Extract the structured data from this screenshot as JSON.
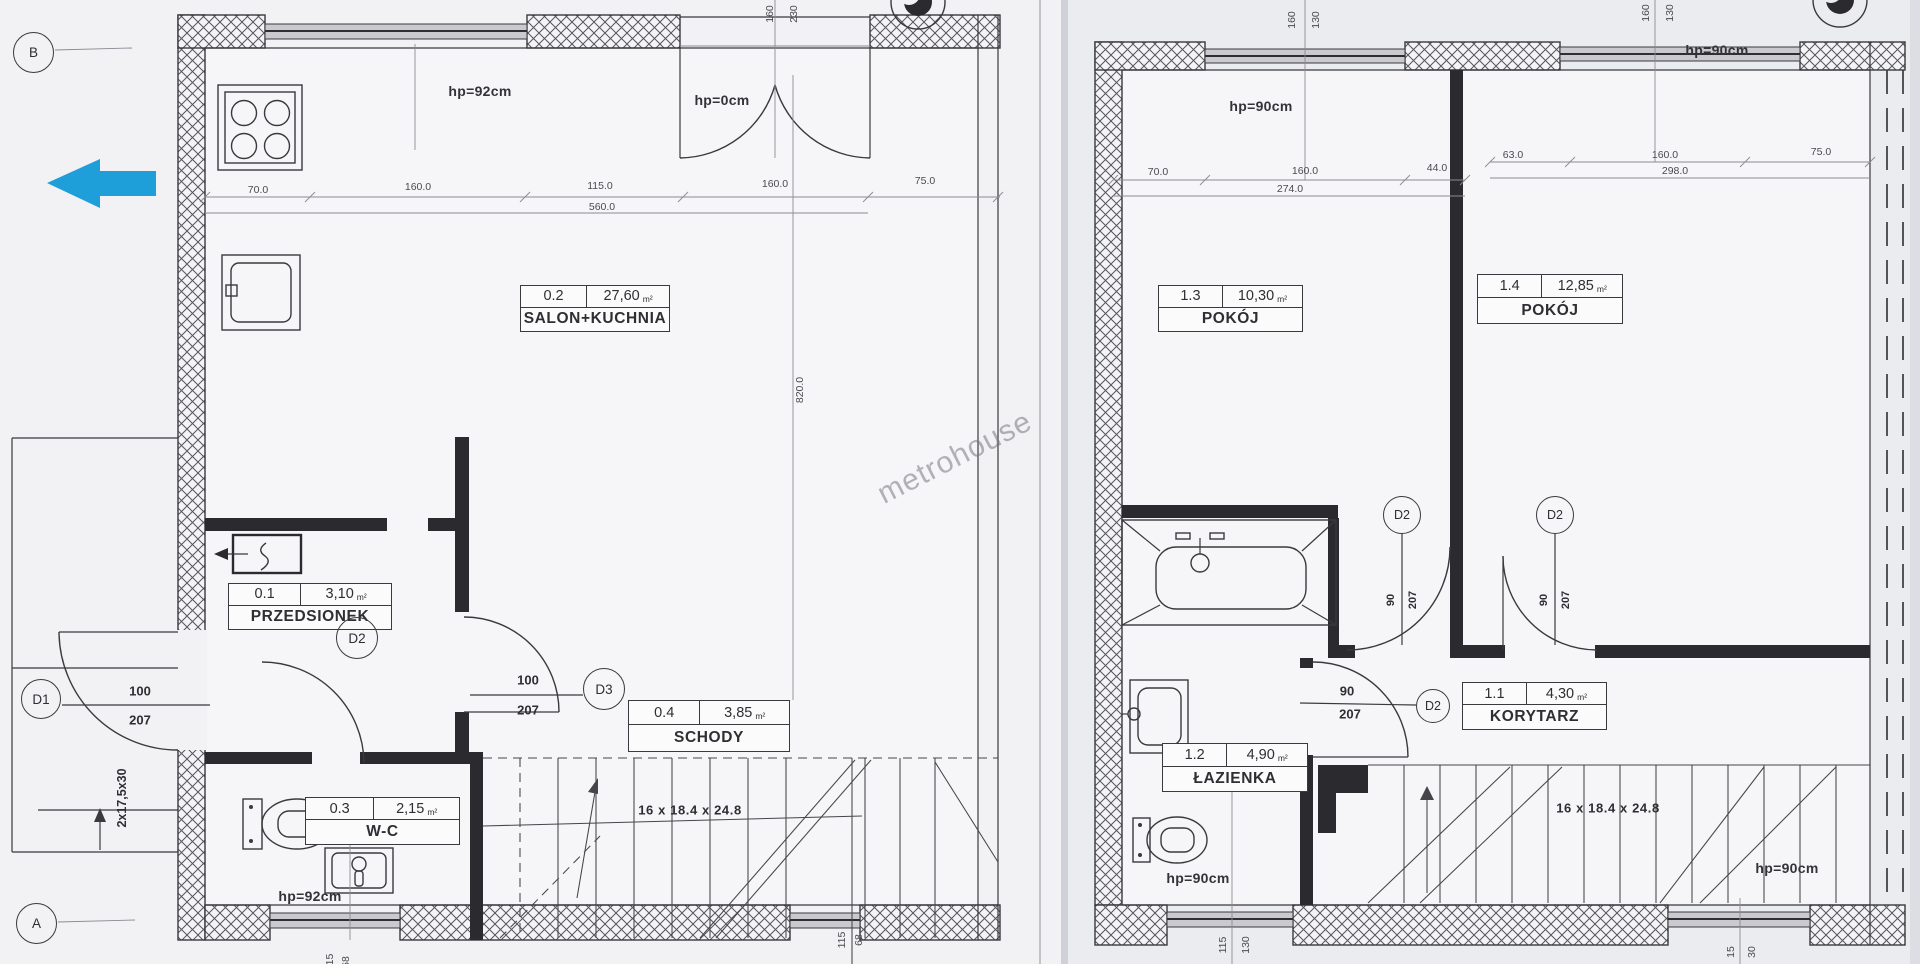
{
  "meta": {
    "unit": "m²",
    "watermark": "metrohouse"
  },
  "markers": {
    "b": "B",
    "a": "A"
  },
  "left_plan": {
    "hp_top": "hp=92cm",
    "hp_entry": "hp=0cm",
    "hp_wc": "hp=92cm",
    "dims_top": {
      "a": "70.0",
      "b": "160.0",
      "c": "115.0",
      "d": "160.0",
      "e": "75.0",
      "total": "560.0"
    },
    "door_top": {
      "w": "160",
      "h": "230"
    },
    "depth": "820.0",
    "rooms": {
      "salon": {
        "id": "0.2",
        "area": "27,60",
        "name": "SALON+KUCHNIA"
      },
      "hall": {
        "id": "0.1",
        "area": "3,10",
        "name": "PRZEDSIONEK"
      },
      "wc": {
        "id": "0.3",
        "area": "2,15",
        "name": "W-C"
      },
      "stairs": {
        "id": "0.4",
        "area": "3,85",
        "name": "SCHODY"
      }
    },
    "doors": {
      "d1": {
        "label": "D1",
        "w": "100",
        "h": "207"
      },
      "d2": {
        "label": "D2"
      },
      "d3": {
        "label": "D3",
        "w": "100",
        "h": "207"
      }
    },
    "stairs_formula": "16 x 18.4 x 24.8",
    "steps_label": "2x17,5x30",
    "bottom": {
      "w": "115",
      "h": "68"
    },
    "bottom2": {
      "w": "115",
      "h": "68"
    }
  },
  "right_plan": {
    "hp_tl": "hp=90cm",
    "hp_tr": "hp=90cm",
    "hp_bl": "hp=90cm",
    "hp_br": "hp=90cm",
    "dims_tl": {
      "a": "70.0",
      "b": "160.0",
      "c": "44.0",
      "total": "274.0"
    },
    "dims_tr": {
      "a": "63.0",
      "b": "160.0",
      "c": "75.0",
      "total": "298.0"
    },
    "win_l": {
      "w": "160",
      "h": "130"
    },
    "win_r": {
      "w": "160",
      "h": "130"
    },
    "rooms": {
      "p13": {
        "id": "1.3",
        "area": "10,30",
        "name": "POKÓJ"
      },
      "p14": {
        "id": "1.4",
        "area": "12,85",
        "name": "POKÓJ"
      },
      "kor": {
        "id": "1.1",
        "area": "4,30",
        "name": "KORYTARZ"
      },
      "laz": {
        "id": "1.2",
        "area": "4,90",
        "name": "ŁAZIENKA"
      }
    },
    "doors": {
      "a": {
        "label": "D2",
        "w": "90",
        "h": "207"
      },
      "b": {
        "label": "D2",
        "w": "90",
        "h": "207"
      },
      "c": {
        "label": "D2",
        "w": "90",
        "h": "207"
      }
    },
    "stairs_formula": "16 x 18.4 x 24.8",
    "bottom_l": {
      "w": "115",
      "h": "130"
    },
    "bottom_r": {
      "w": "15",
      "h": "30"
    }
  }
}
